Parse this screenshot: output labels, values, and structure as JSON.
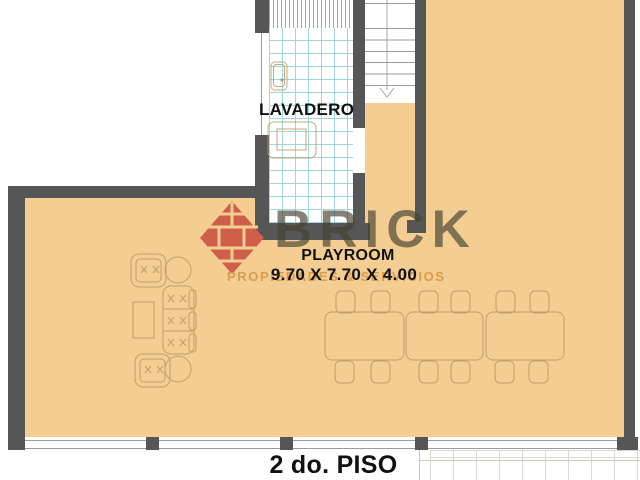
{
  "title": "2 do. PISO",
  "rooms": {
    "lavadero": {
      "label": "LAVADERO"
    },
    "playroom": {
      "label": "PLAYROOM",
      "dimensions": "9.70 X 7.70 X 4.00"
    }
  },
  "stair": {
    "icon": "stair-down-arrow-icon"
  },
  "watermark": {
    "brand": "BRICK",
    "tagline": "PROPIEDADES & SERVICIOS"
  },
  "colors": {
    "floor": "#F4CD92",
    "wall": "#565657",
    "tile_line": "#9ED8DA",
    "stair_line": "#9a9a9a",
    "furniture_line": "#b9995f",
    "grid_line": "#d9dbd0",
    "logo_red": "#cf5f49"
  }
}
